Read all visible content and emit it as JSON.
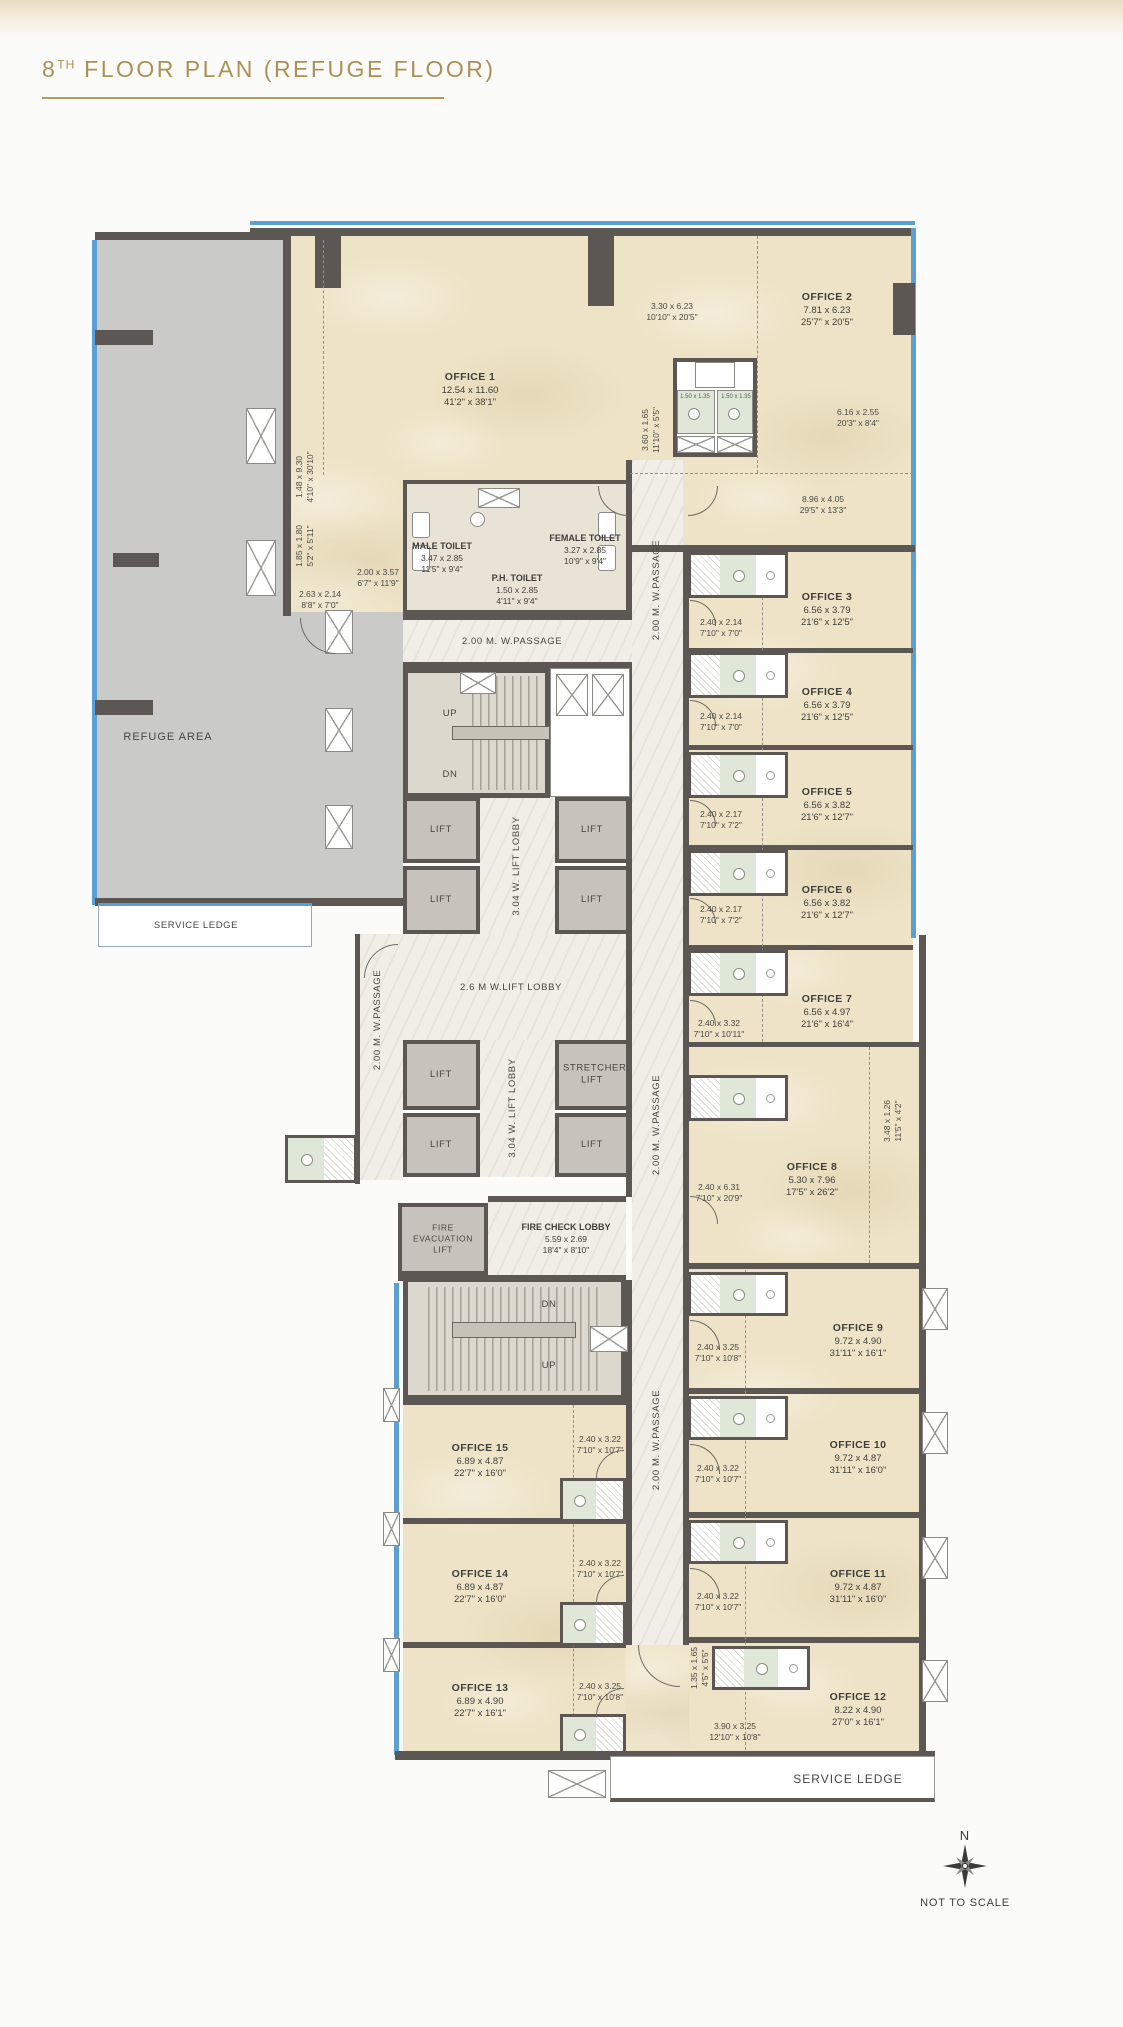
{
  "title": {
    "num": "8",
    "sup": "TH",
    "rest": " FLOOR PLAN (REFUGE FLOOR)"
  },
  "offices": [
    {
      "name": "OFFICE 1",
      "m": "12.54 x 11.60",
      "i": "41'2\" x 38'1\""
    },
    {
      "name": "OFFICE 2",
      "m": "7.81 x 6.23",
      "i": "25'7\" x 20'5\""
    },
    {
      "name": "OFFICE 3",
      "m": "6.56 x 3.79",
      "i": "21'6\" x 12'5\""
    },
    {
      "name": "OFFICE 4",
      "m": "6.56 x 3.79",
      "i": "21'6\" x 12'5\""
    },
    {
      "name": "OFFICE 5",
      "m": "6.56 x 3.82",
      "i": "21'6\" x 12'7\""
    },
    {
      "name": "OFFICE 6",
      "m": "6.56 x 3.82",
      "i": "21'6\" x 12'7\""
    },
    {
      "name": "OFFICE 7",
      "m": "6.56 x 4.97",
      "i": "21'6\" x 16'4\""
    },
    {
      "name": "OFFICE 8",
      "m": "5.30 x 7.96",
      "i": "17'5\" x 26'2\""
    },
    {
      "name": "OFFICE 9",
      "m": "9.72 x 4.90",
      "i": "31'11\" x 16'1\""
    },
    {
      "name": "OFFICE 10",
      "m": "9.72 x 4.87",
      "i": "31'11\" x 16'0\""
    },
    {
      "name": "OFFICE 11",
      "m": "9.72 x 4.87",
      "i": "31'11\" x 16'0\""
    },
    {
      "name": "OFFICE 12",
      "m": "8.22 x 4.90",
      "i": "27'0\" x 16'1\""
    },
    {
      "name": "OFFICE 13",
      "m": "6.89 x 4.90",
      "i": "22'7\" x 16'1\""
    },
    {
      "name": "OFFICE 14",
      "m": "6.89 x 4.87",
      "i": "22'7\" x 16'0\""
    },
    {
      "name": "OFFICE 15",
      "m": "6.89 x 4.87",
      "i": "22'7\" x 16'0\""
    }
  ],
  "toilets": {
    "male": {
      "name": "MALE TOILET",
      "m": "3.47 x 2.85",
      "i": "11'5\" x 9'4\""
    },
    "female": {
      "name": "FEMALE TOILET",
      "m": "3.27 x 2.85",
      "i": "10'9\" x 9'4\""
    },
    "ph": {
      "name": "P.H. TOILET",
      "m": "1.50 x 2.85",
      "i": "4'11\" x 9'4\""
    }
  },
  "wc_dim": "1.50 x 1.35",
  "dims": [
    {
      "m": "3.30 x 6.23",
      "i": "10'10\" x 20'5\""
    },
    {
      "m": "3.60 x 1.65",
      "i": "11'10\" x 5'5\""
    },
    {
      "m": "6.16 x 2.55",
      "i": "20'3\" x 8'4\""
    },
    {
      "m": "8.96 x 4.05",
      "i": "29'5\" x 13'3\""
    },
    {
      "m": "1.48 x 9.30",
      "i": "4'10\" x 30'10\""
    },
    {
      "m": "1.85 x 1.80",
      "i": "5'2\" x 5'11\""
    },
    {
      "m": "2.00 x 3.57",
      "i": "6'7\" x 11'9\""
    },
    {
      "m": "2.63 x 2.14",
      "i": "8'8\" x 7'0\""
    },
    {
      "m": "2.40 x 2.14",
      "i": "7'10\" x 7'0\""
    },
    {
      "m": "2.40 x 2.14",
      "i": "7'10\" x 7'0\""
    },
    {
      "m": "2.40 x 2.17",
      "i": "7'10\" x 7'2\""
    },
    {
      "m": "2.40 x 2.17",
      "i": "7'10\" x 7'2\""
    },
    {
      "m": "2.40 x 3.32",
      "i": "7'10\" x 10'11\""
    },
    {
      "m": "2.40 x 6.31",
      "i": "7'10\" x 20'9\""
    },
    {
      "m": "3.48 x 1.26",
      "i": "11'5\" x 4'2\""
    },
    {
      "m": "2.40 x 3.25",
      "i": "7'10\" x 10'8\""
    },
    {
      "m": "2.40 x 3.22",
      "i": "7'10\" x 10'7\""
    },
    {
      "m": "2.40 x 3.22",
      "i": "7'10\" x 10'7\""
    },
    {
      "m": "1.35 x 1.65",
      "i": "4'5\" x 5'5\""
    },
    {
      "m": "3.90 x 3.25",
      "i": "12'10\" x 10'8\""
    },
    {
      "m": "2.40 x 3.22",
      "i": "7'10\" x 10'7\""
    },
    {
      "m": "2.40 x 3.22",
      "i": "7'10\" x 10'7\""
    },
    {
      "m": "2.40 x 3.25",
      "i": "7'10\" x 10'8\""
    }
  ],
  "circ": {
    "passage": "2.00 M.  W.PASSAGE",
    "lobby26": "2.6 M  W.LIFT LOBBY",
    "lobby304": "3.04 W.  LIFT LOBBY",
    "lift": "LIFT",
    "stretcher": "STRETCHER LIFT",
    "fire_evac": "FIRE EVACUATION LIFT",
    "fire_check": {
      "name": "FIRE CHECK LOBBY",
      "m": "5.59 x 2.69",
      "i": "18'4\" x 8'10\""
    },
    "up": "UP",
    "dn": "DN",
    "refuge": "REFUGE AREA",
    "service_ledge": "SERVICE LEDGE"
  },
  "compass": {
    "n": "N",
    "note": "NOT TO SCALE"
  },
  "colors": {
    "accent": "#ad9154",
    "wall": "#5c5753",
    "glazing": "#5b9fd4",
    "office_floor": "#eee3c6",
    "refuge": "#cacac9",
    "corridor": "#f1eee7"
  }
}
